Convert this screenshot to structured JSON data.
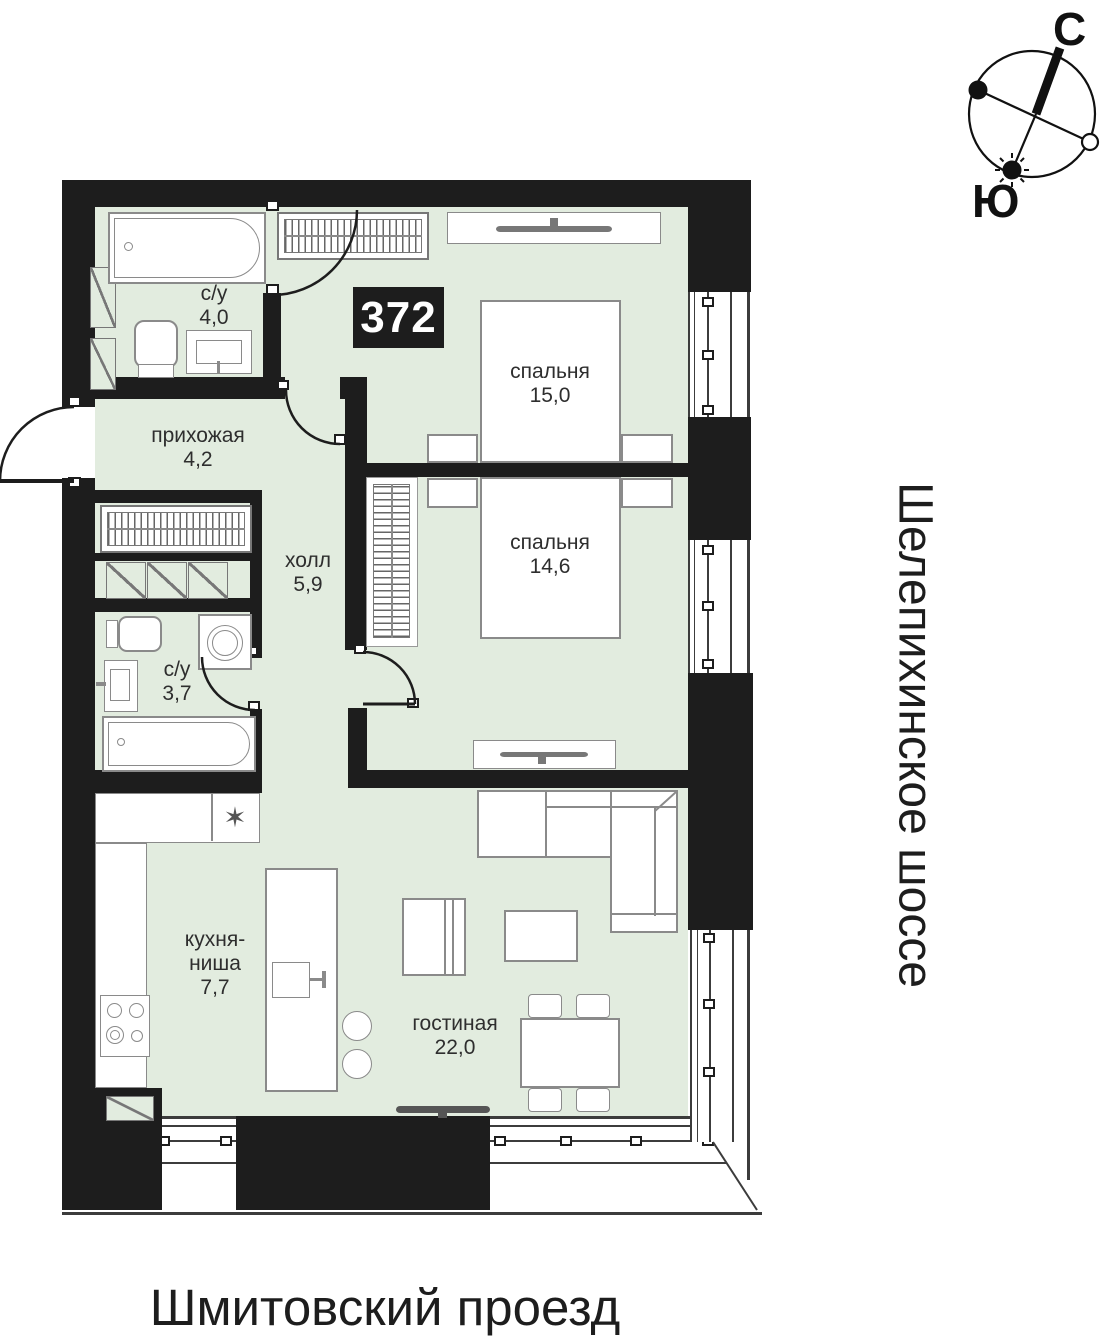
{
  "apartment": {
    "number": "372"
  },
  "rooms": {
    "bath_top": {
      "name": "с/у",
      "area": "4,0"
    },
    "hallway": {
      "name": "прихожая",
      "area": "4,2"
    },
    "hall": {
      "name": "холл",
      "area": "5,9"
    },
    "bath_mid": {
      "name": "с/у",
      "area": "3,7"
    },
    "bedroom1": {
      "name": "спальня",
      "area": "15,0"
    },
    "bedroom2": {
      "name": "спальня",
      "area": "14,6"
    },
    "kitchen": {
      "name": "кухня-",
      "name2": "ниша",
      "area": "7,7"
    },
    "living": {
      "name": "гостиная",
      "area": "22,0"
    }
  },
  "streets": {
    "side": "Шелепихинское шоссе",
    "bottom": "Шмитовский проезд"
  },
  "compass": {
    "north": "С",
    "south": "Ю"
  },
  "symbols": {
    "kitchen_appliance": "✶"
  },
  "colors": {
    "floor": "#e2ecdf",
    "wall": "#1d1d1d",
    "furniture_outline": "#8a8a8a"
  }
}
